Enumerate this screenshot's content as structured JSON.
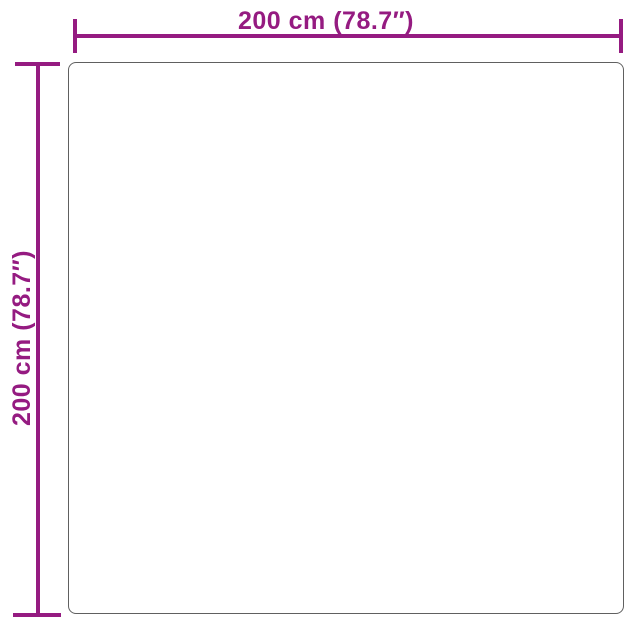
{
  "figure": {
    "type": "product-dimension-diagram",
    "product_shape": "square",
    "accent_color": "#951b81",
    "outline_color": "#606060",
    "background_color": "#ffffff",
    "width_dimension": {
      "label": "200 cm (78.7″)",
      "value_cm": 200,
      "value_inches": 78.7
    },
    "height_dimension": {
      "label": "200 cm (78.7″)",
      "value_cm": 200,
      "value_inches": 78.7
    }
  }
}
